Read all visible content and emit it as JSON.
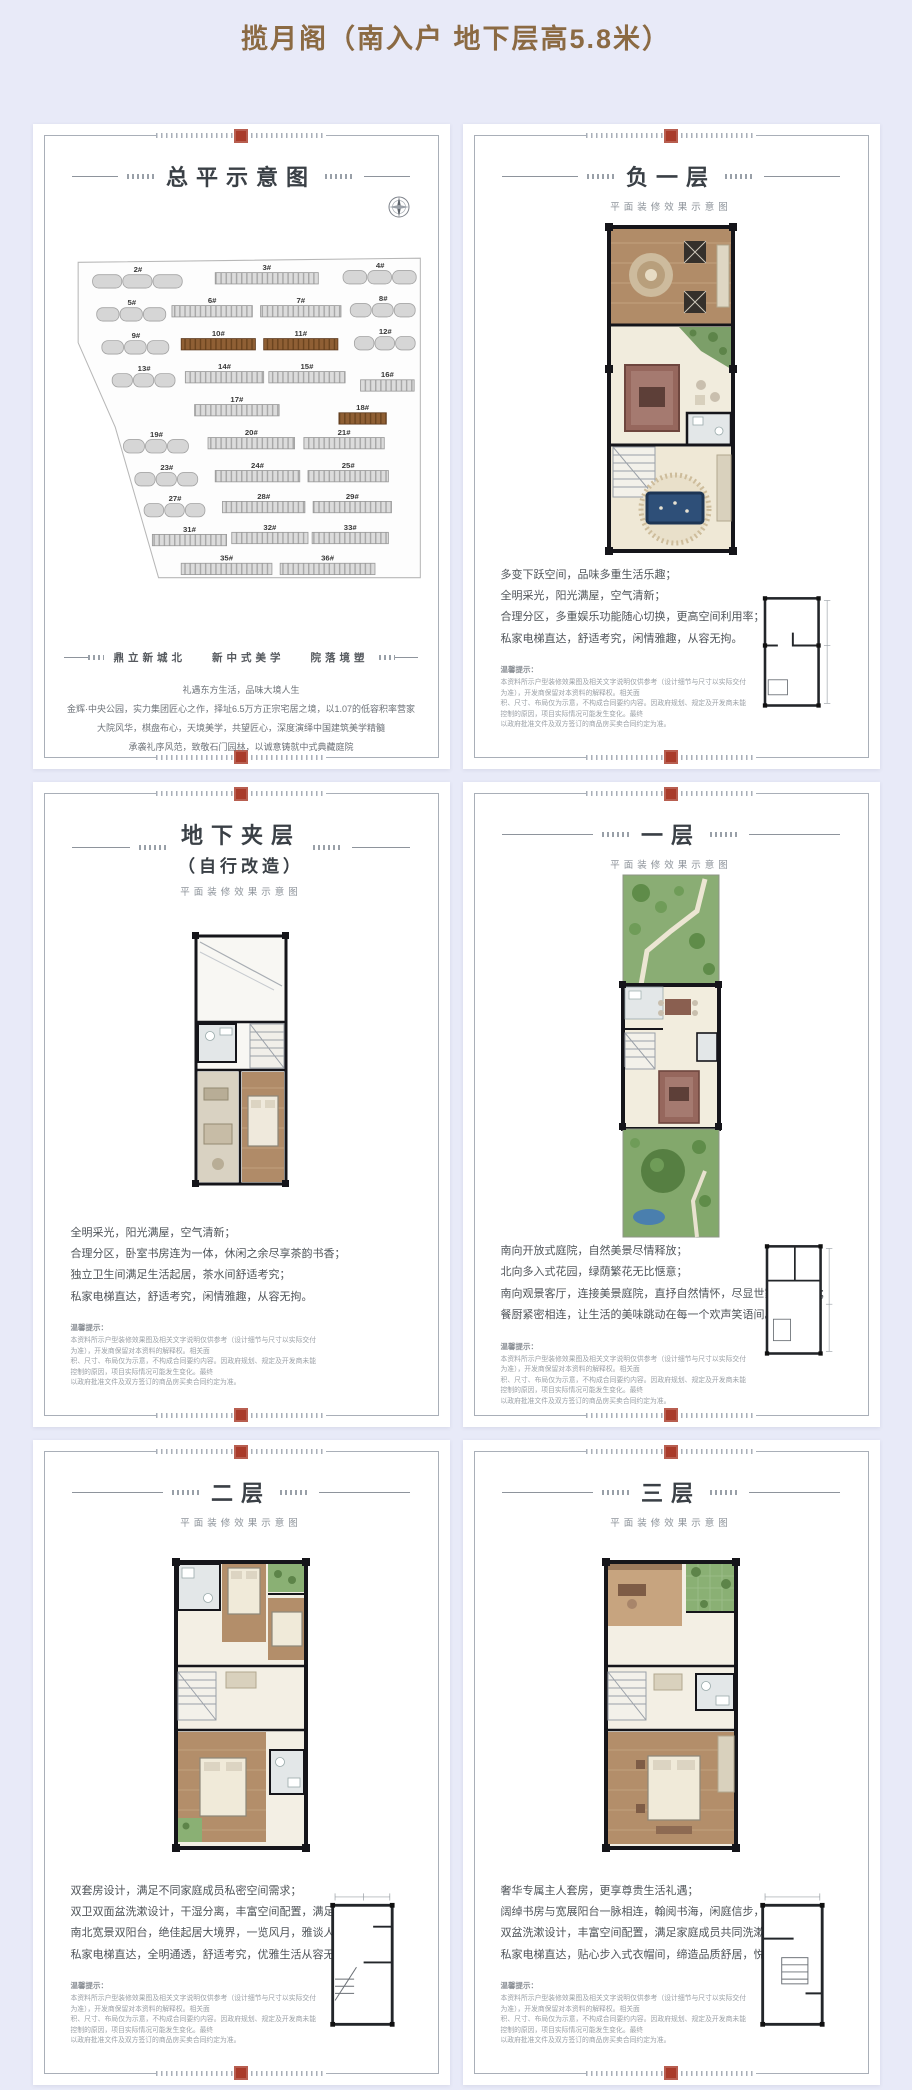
{
  "page": {
    "title": "揽月阁（南入户 地下层高5.8米）",
    "background": "#e8eaf8",
    "title_color": "#8b6a43",
    "seal_color": "#a93b2a",
    "highlight_building_color": "#8f5f34"
  },
  "common": {
    "subtitle": "平面装修效果示意图",
    "disclaimer_heading": "温馨提示：",
    "disclaimer_lines": [
      "本资料所示户型装修效果图及相关文字说明仅供参考（设计细节与尺寸以实际交付为准），开发商保留对本资料的解释权。相关面",
      "积、尺寸、布局仅为示意，不构成合同要约内容。因政府规划、规定及开发商未能控制的原因，项目实际情况可能发生变化。最终",
      "以政府批准文件及双方签订的商品房买卖合同约定为准。"
    ]
  },
  "site_panel": {
    "title": "总平示意图",
    "slogan": [
      "鼎立新城北",
      "新中式美学",
      "院落境塑"
    ],
    "lines": [
      "礼遇东方生活，品味大境人生",
      "金辉·中央公园，实力集团匠心之作，择址6.5万方正宗宅居之境，以1.07的低容积率营家",
      "大院风华，棋盘布心，天境美学，共望匠心，深度演绎中国建筑美学精髓",
      "承袭礼序风范，致敬石门园林，以诚意铸就中式典藏庭院"
    ],
    "buildings": [
      {
        "label": "2#",
        "t": "lump",
        "x": 80,
        "y": 22,
        "w": 88
      },
      {
        "label": "3#",
        "t": "slab",
        "x": 205,
        "y": 20,
        "w": 100
      },
      {
        "label": "4#",
        "t": "lump",
        "x": 315,
        "y": 18,
        "w": 72
      },
      {
        "label": "5#",
        "t": "lump",
        "x": 74,
        "y": 54,
        "w": 68
      },
      {
        "label": "6#",
        "t": "slab",
        "x": 152,
        "y": 52,
        "w": 78
      },
      {
        "label": "7#",
        "t": "slab",
        "x": 238,
        "y": 52,
        "w": 78
      },
      {
        "label": "8#",
        "t": "lump",
        "x": 318,
        "y": 50,
        "w": 64
      },
      {
        "label": "9#",
        "t": "lump",
        "x": 78,
        "y": 86,
        "w": 66
      },
      {
        "label": "10#",
        "t": "slab",
        "x": 158,
        "y": 84,
        "w": 72,
        "hl": true
      },
      {
        "label": "11#",
        "t": "slab",
        "x": 238,
        "y": 84,
        "w": 72,
        "hl": true
      },
      {
        "label": "12#",
        "t": "lump",
        "x": 320,
        "y": 82,
        "w": 60
      },
      {
        "label": "13#",
        "t": "lump",
        "x": 86,
        "y": 118,
        "w": 62
      },
      {
        "label": "14#",
        "t": "slab",
        "x": 164,
        "y": 116,
        "w": 76
      },
      {
        "label": "15#",
        "t": "slab",
        "x": 244,
        "y": 116,
        "w": 74
      },
      {
        "label": "16#",
        "t": "slab",
        "x": 322,
        "y": 124,
        "w": 52
      },
      {
        "label": "17#",
        "t": "slab",
        "x": 176,
        "y": 148,
        "w": 82
      },
      {
        "label": "18#",
        "t": "slab",
        "x": 298,
        "y": 156,
        "w": 46,
        "hl": true
      },
      {
        "label": "19#",
        "t": "lump",
        "x": 98,
        "y": 182,
        "w": 64
      },
      {
        "label": "20#",
        "t": "slab",
        "x": 190,
        "y": 180,
        "w": 84
      },
      {
        "label": "21#",
        "t": "slab",
        "x": 280,
        "y": 180,
        "w": 78
      },
      {
        "label": "23#",
        "t": "lump",
        "x": 108,
        "y": 214,
        "w": 62
      },
      {
        "label": "24#",
        "t": "slab",
        "x": 196,
        "y": 212,
        "w": 82
      },
      {
        "label": "25#",
        "t": "slab",
        "x": 284,
        "y": 212,
        "w": 78
      },
      {
        "label": "27#",
        "t": "lump",
        "x": 116,
        "y": 244,
        "w": 60
      },
      {
        "label": "28#",
        "t": "slab",
        "x": 202,
        "y": 242,
        "w": 80
      },
      {
        "label": "29#",
        "t": "slab",
        "x": 288,
        "y": 242,
        "w": 76
      },
      {
        "label": "31#",
        "t": "slab",
        "x": 130,
        "y": 274,
        "w": 72
      },
      {
        "label": "32#",
        "t": "slab",
        "x": 208,
        "y": 272,
        "w": 74
      },
      {
        "label": "33#",
        "t": "slab",
        "x": 286,
        "y": 272,
        "w": 74
      },
      {
        "label": "35#",
        "t": "slab",
        "x": 166,
        "y": 302,
        "w": 88
      },
      {
        "label": "36#",
        "t": "slab",
        "x": 264,
        "y": 302,
        "w": 92
      }
    ]
  },
  "floor_panels": [
    {
      "title": "负一层",
      "lines": [
        "多变下跃空间，品味多重生活乐趣；",
        "全明采光，阳光满屋，空气清新；",
        "合理分区，多重娱乐功能随心切换，更高空间利用率；",
        "私家电梯直达，舒适考究，闲情雅趣，从容无拘。"
      ]
    },
    {
      "title": "地下夹层",
      "title2": "（自行改造）",
      "lines": [
        "全明采光，阳光满屋，空气清新；",
        "合理分区，卧室书房连为一体，休闲之余尽享茶韵书香；",
        "独立卫生间满足生活起居，茶水间舒适考究；",
        "私家电梯直达，舒适考究，闲情雅趣，从容无拘。"
      ]
    },
    {
      "title": "一层",
      "lines": [
        "南向开放式庭院，自然美景尽情释放；",
        "北向多入式花园，绿荫繁花无比惬意；",
        "南向观景客厅，连接美景庭院，直抒自然情怀，尽显世家大户风范；",
        "餐厨紧密相连，让生活的美味跳动在每一个欢声笑语间。"
      ]
    },
    {
      "title": "二层",
      "lines": [
        "双套房设计，满足不同家庭成员私密空间需求；",
        "双卫双面盆洗漱设计，干湿分离，丰富空间配置，满足共同洗漱；",
        "南北宽景双阳台，绝佳起居大境界，一览风月，雅谈人生；",
        "私家电梯直达，全明通透，舒适考究，优雅生活从容无拘。"
      ]
    },
    {
      "title": "三层",
      "lines": [
        "奢华专属主人套房，更享尊贵生活礼遇；",
        "阔绰书房与宽展阳台一脉相连，翰阅书海，闲庭信步，挥斥方遒；",
        "双盆洗漱设计，丰富空间配置，满足家庭成员共同洗漱；",
        "私家电梯直达，贴心步入式衣帽间，缔造品质舒居，悦享惬意人生。"
      ]
    }
  ]
}
